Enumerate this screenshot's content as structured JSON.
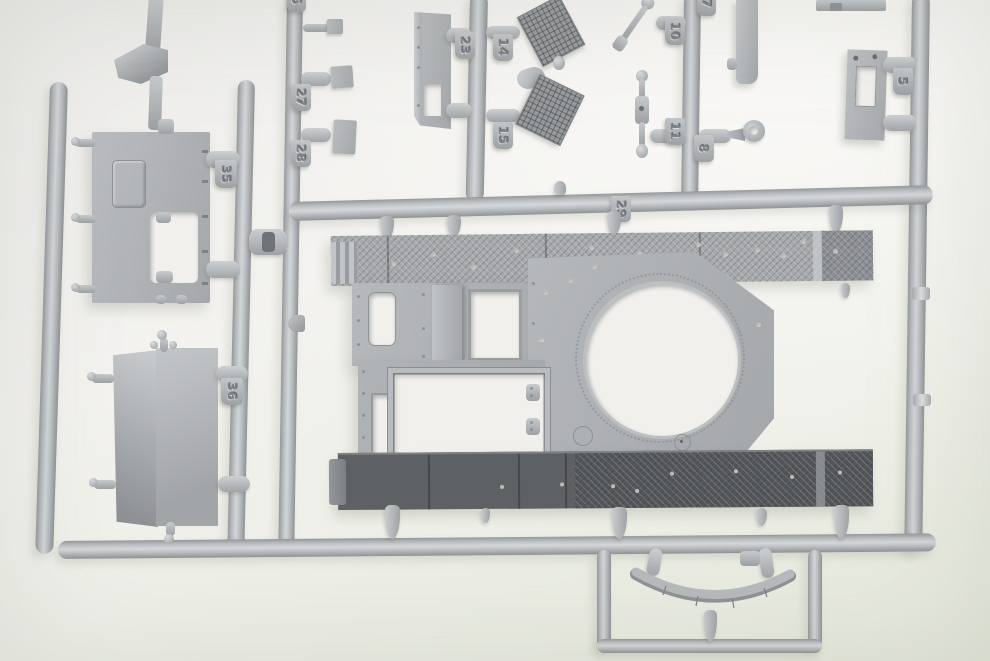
{
  "photo": {
    "subject": "Light-grey styrene model-kit sprue (parts tree) with tank hull deck, hatch panels, grilles and fittings, photographed on a pale backdrop",
    "plastic_color": "#b5b8bb",
    "dark_panel_color": "#5e6163",
    "background_top": "#f3f2ef",
    "background_bottom": "#e5e8dc"
  },
  "tags": {
    "t5": "5",
    "t6": "6",
    "t7": "7",
    "t8": "8",
    "t10": "10",
    "t11": "11",
    "t14": "14",
    "t15": "15",
    "t23": "23",
    "t27": "27",
    "t28": "28",
    "t29": "29",
    "t35": "35",
    "t36": "36"
  }
}
